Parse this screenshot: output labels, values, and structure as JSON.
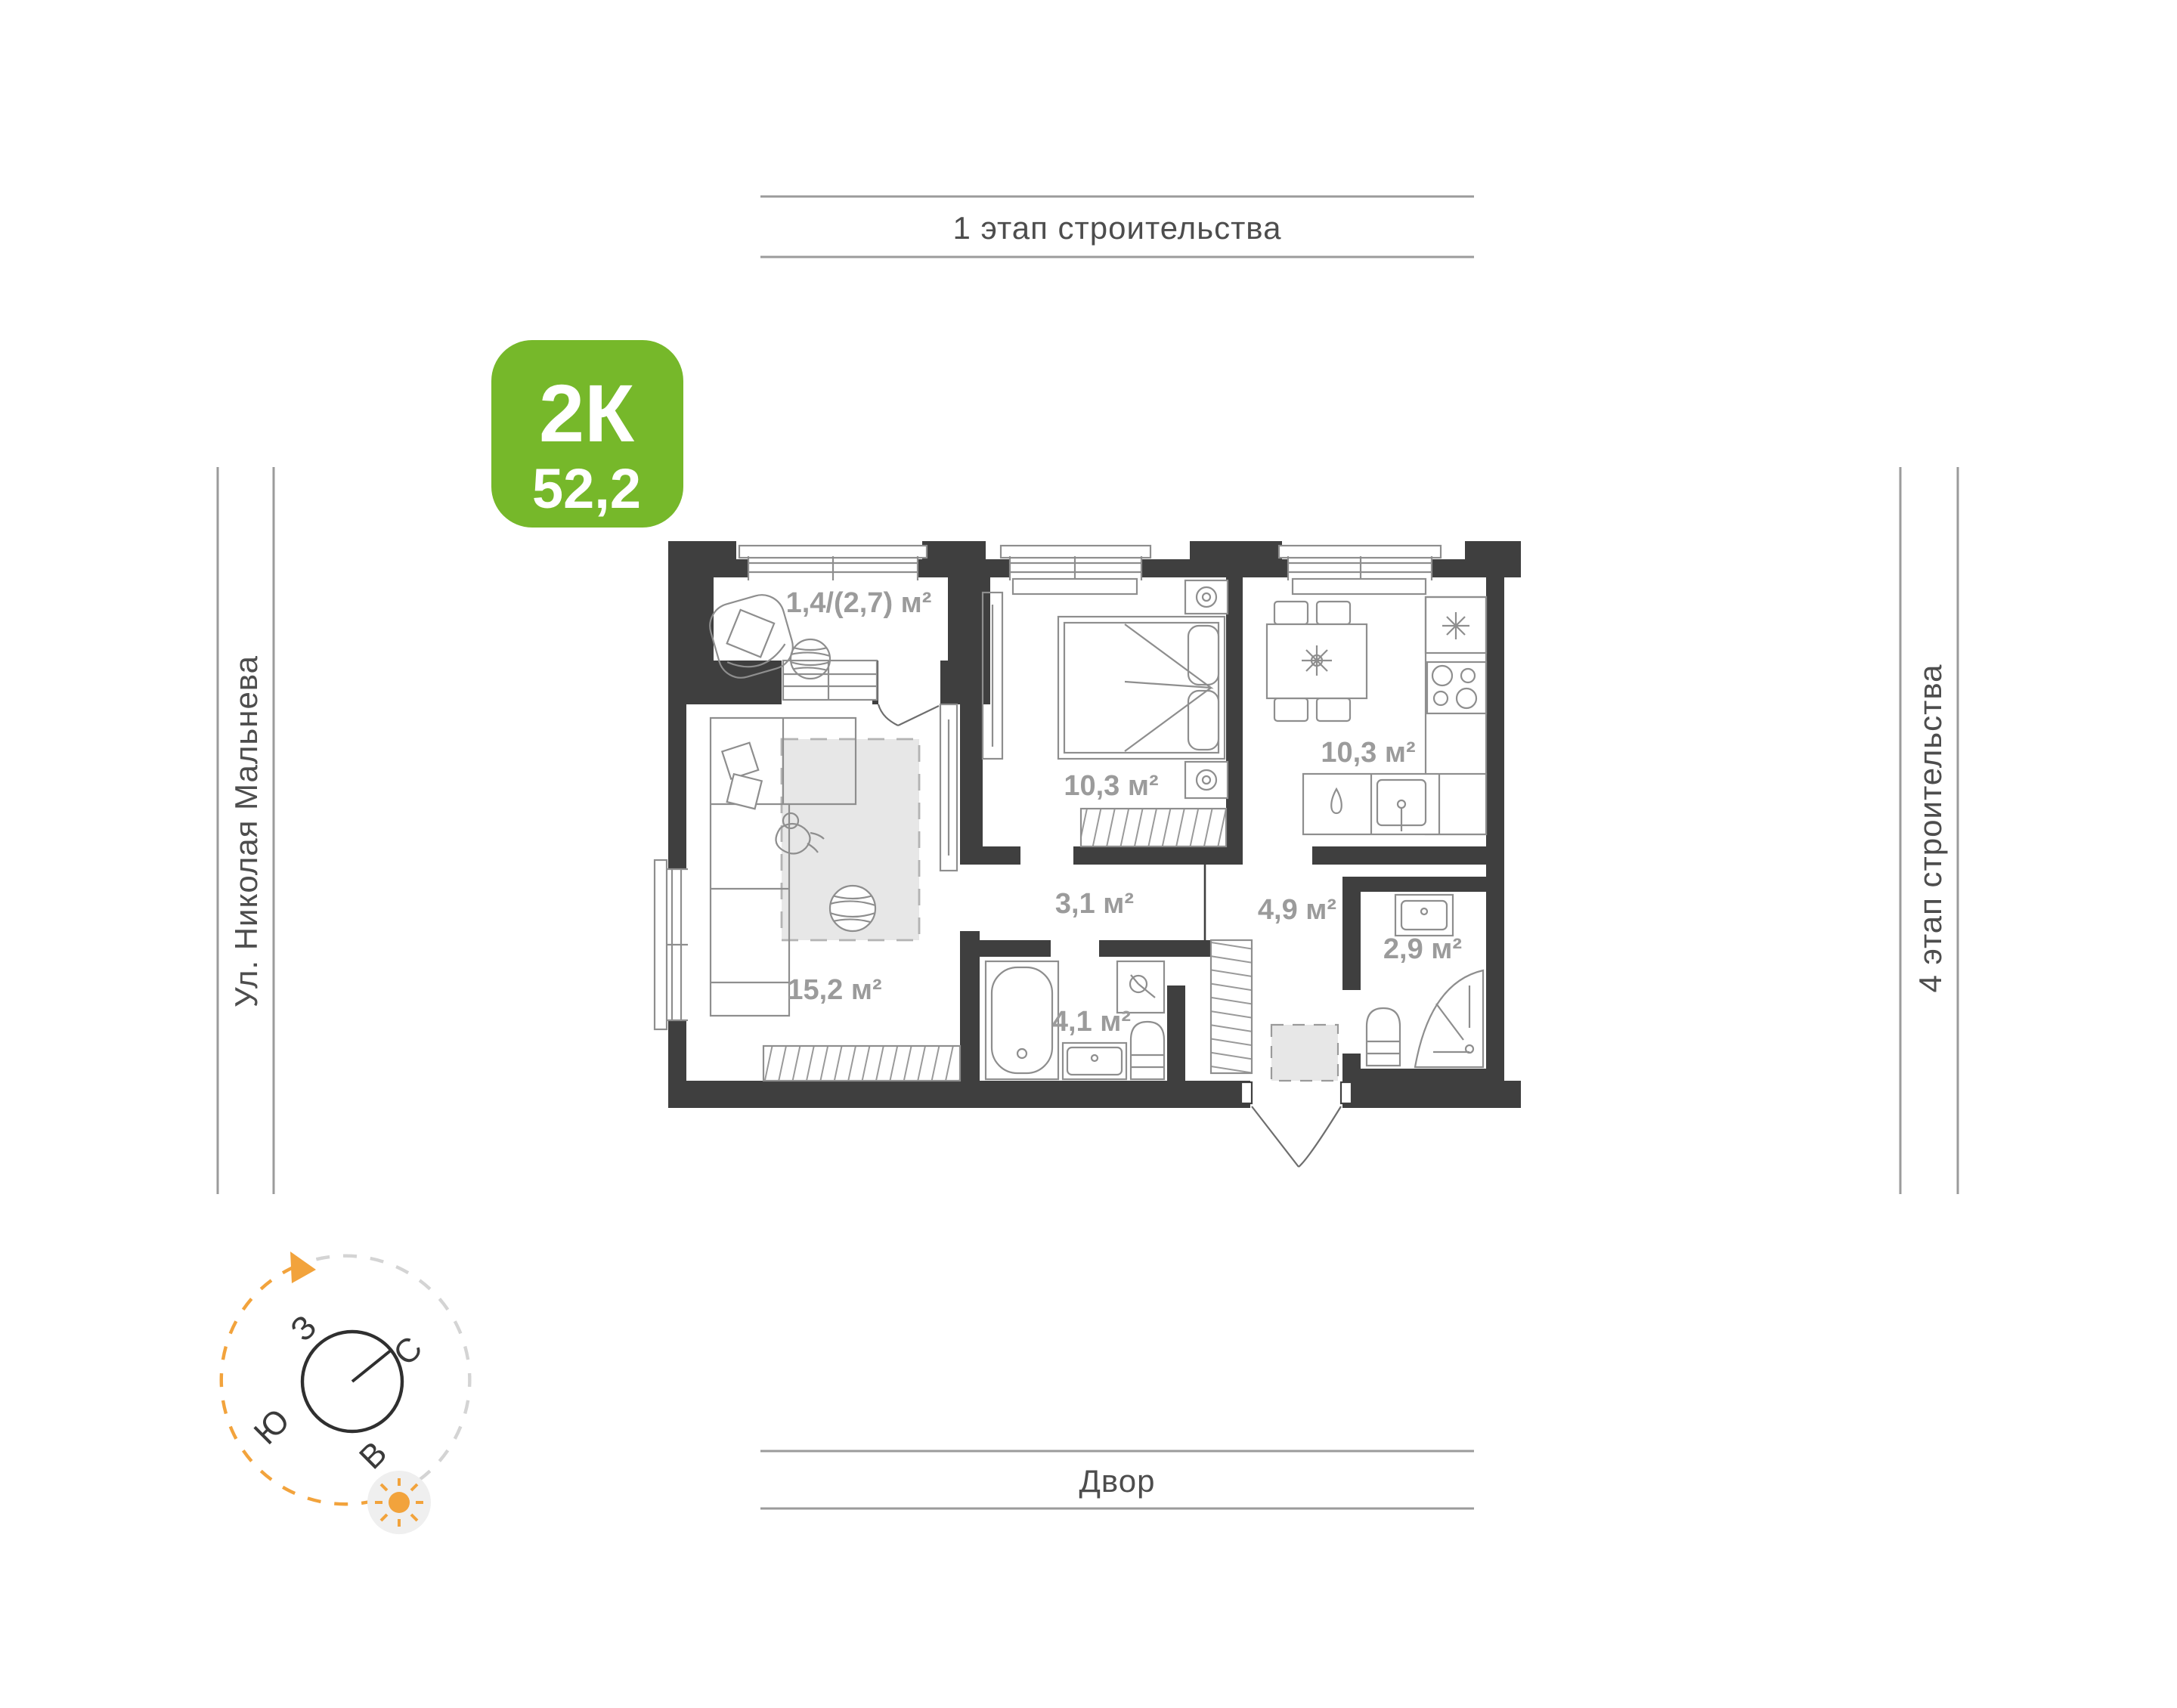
{
  "badge": {
    "rooms_label": "2К",
    "area_value": "52,2"
  },
  "surroundings": {
    "top_label": "1 этап строительства",
    "left_label": "Ул. Николая Мальнева",
    "right_label": "4 этап строительства",
    "bottom_label": "Двор"
  },
  "compass": {
    "west": "З",
    "north": "С",
    "south": "Ю",
    "east": "В"
  },
  "plan": {
    "room_labels": {
      "balcony": "1,4/(2,7) м²",
      "bedroom": "10,3 м²",
      "kitchen": "10,3 м²",
      "living_room": "15,2 м²",
      "corridor": "3,1 м²",
      "entrance_hall": "4,9 м²",
      "bathroom": "4,1 м²",
      "shower_room": "2,9 м²"
    }
  },
  "colors": {
    "accent_green": "#76B82A",
    "wall": "#3F3F3F",
    "room_label_gray": "#9B9B9B",
    "guide_line_gray": "#9B9B9B",
    "street_text": "#4D4D4D",
    "sun_orange": "#F2A33C",
    "furniture_stroke": "#8E8E8E",
    "rug_fill": "#E7E7E7"
  }
}
